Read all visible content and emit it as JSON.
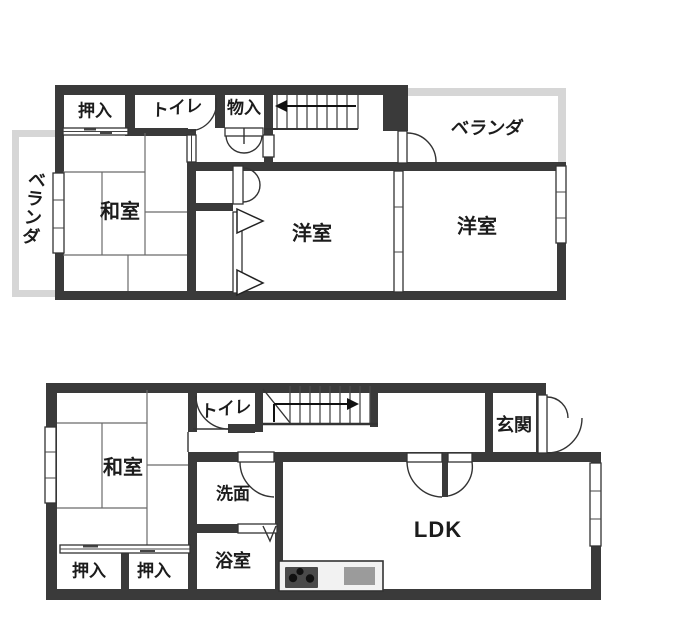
{
  "title": "2-story house floor plan",
  "colors": {
    "wall": "#3a3a3a",
    "line": "#333333",
    "veranda": "#d6d6d6",
    "text": "#1c1c1c",
    "stove": "#4a4a4a",
    "sink": "#9b9b9b",
    "counter": "#f2f2f2",
    "burner": "#111111"
  },
  "floor2": {
    "oshiire": "押入",
    "toilet": "トイレ",
    "monoire": "物入",
    "veranda_right": "ベランダ",
    "washitsu": "和室",
    "yoshitsu_center": "洋室",
    "yoshitsu_right": "洋室",
    "veranda_left": "ベランダ"
  },
  "floor1": {
    "toilet": "トイレ",
    "genkan": "玄関",
    "washitsu": "和室",
    "senmen": "洗面",
    "ldk": "LDK",
    "bathroom": "浴室",
    "oshiire_1": "押入",
    "oshiire_2": "押入"
  },
  "icons": {
    "stairs_up_2f": "stair-arrow-left",
    "stairs_up_1f": "stair-arrow-right",
    "kitchen": "stove-with-burners-and-sink"
  }
}
